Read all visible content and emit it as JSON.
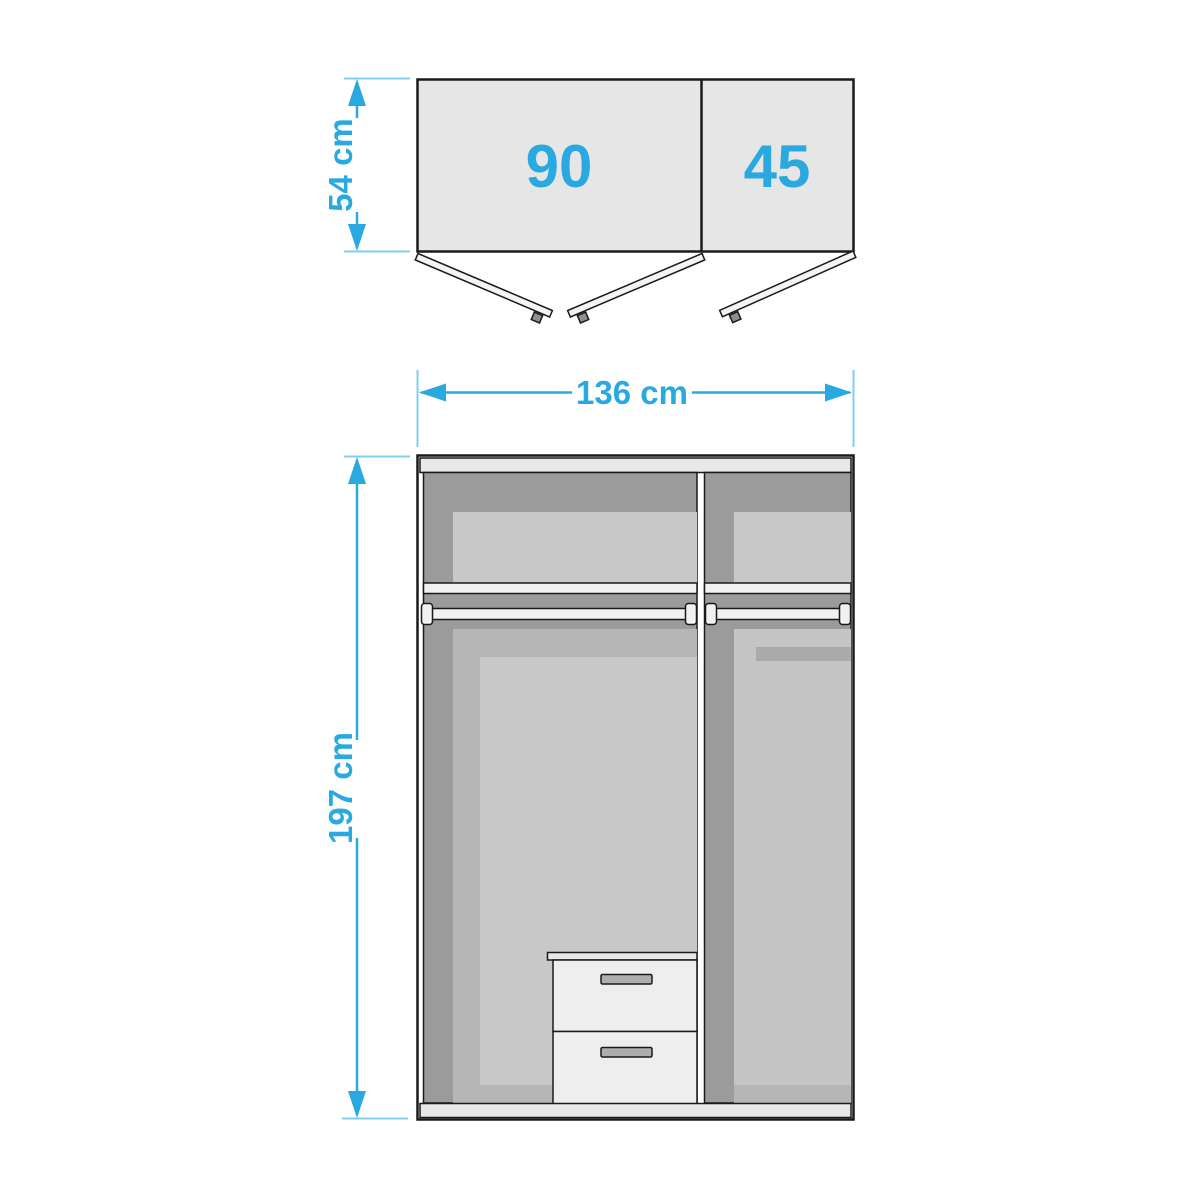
{
  "diagram": {
    "top_view": {
      "left_door_label": "90",
      "right_door_label": "45",
      "depth_dimension": "54 cm"
    },
    "front_view": {
      "width_dimension": "136 cm",
      "height_dimension": "197 cm"
    },
    "palette": {
      "accent": "#29a9e0",
      "extension_line": "#7fcfef",
      "outline": "#1a1a1a",
      "door_fill": "#e6e6e6",
      "door_leaf": "#f4f4f4",
      "interior_dark": "#9b9b9b",
      "interior_mid": "#b6b6b6",
      "interior_light": "#c8c8c8",
      "interior_light_alt": "#c5c5c5",
      "shadow_band": "#ababab",
      "bottom_band": "#b5b5b5",
      "shelf_white": "#f1f1f1",
      "strip_light": "#e8e8e8",
      "drawer_front": "#eeeeee",
      "handle_gray": "#aeaeae",
      "knob_gray": "#8f8f8f"
    }
  }
}
